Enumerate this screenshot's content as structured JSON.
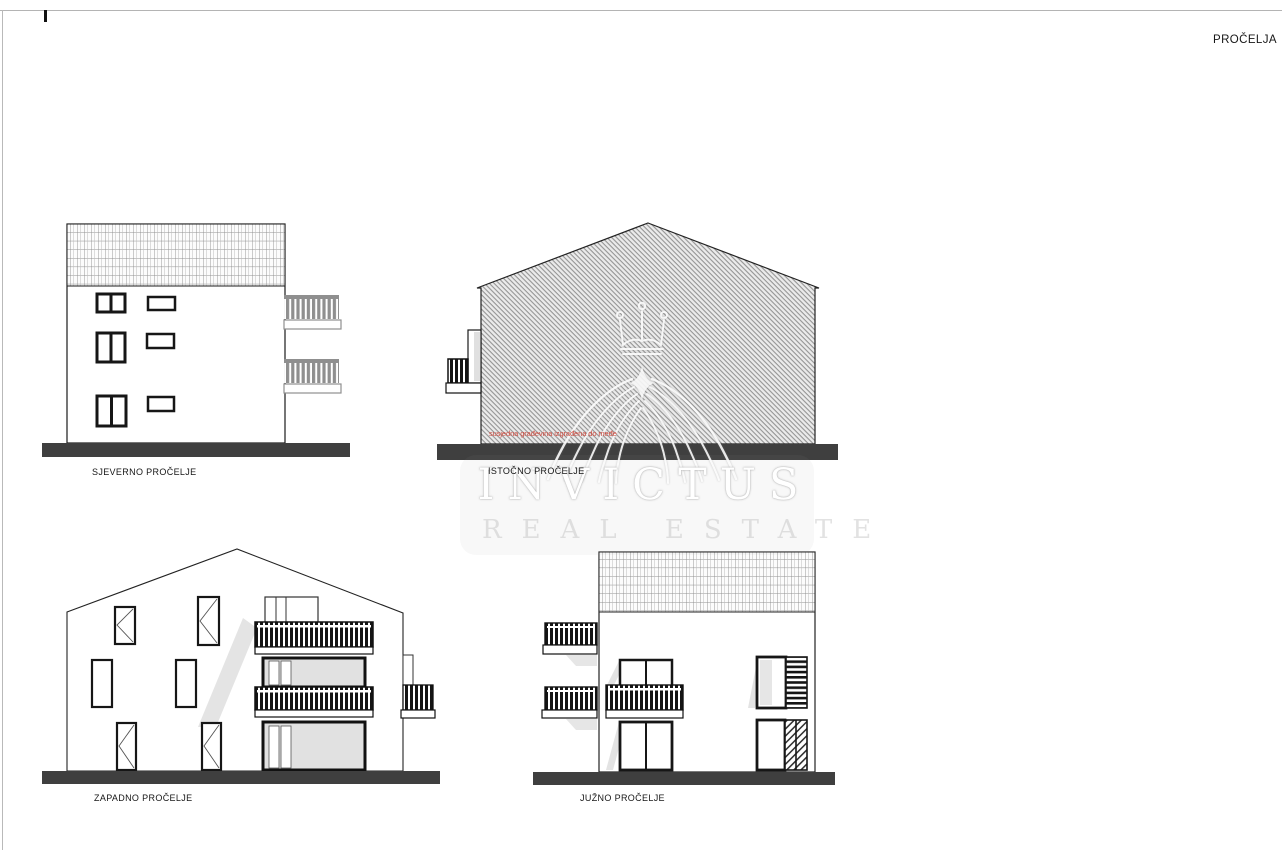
{
  "frame": {
    "title": "PROČELJA"
  },
  "elevations": {
    "north": {
      "label": "SJEVERNO PROČELJE"
    },
    "east": {
      "label": "ISTOČNO PROČELJE",
      "annotation": "susjedna građevina izgrađena do međe",
      "annotation_color": "#cf4a3e"
    },
    "west": {
      "label": "ZAPADNO PROČELJE"
    },
    "south": {
      "label": "JUŽNO PROČELJE"
    }
  },
  "watermark": {
    "brand": "INVICTUS",
    "tagline": "REAL ESTATE",
    "logo": "winged-crown-emblem"
  },
  "colors": {
    "ground_line": "#3f3f3f",
    "outline": "#1a1a1a",
    "facade_hatch_gray": "#949494",
    "railing_gray": "#8f8f8f",
    "shadow_gray": "#e3e3e3",
    "annotation_red": "#cf4a3e"
  }
}
